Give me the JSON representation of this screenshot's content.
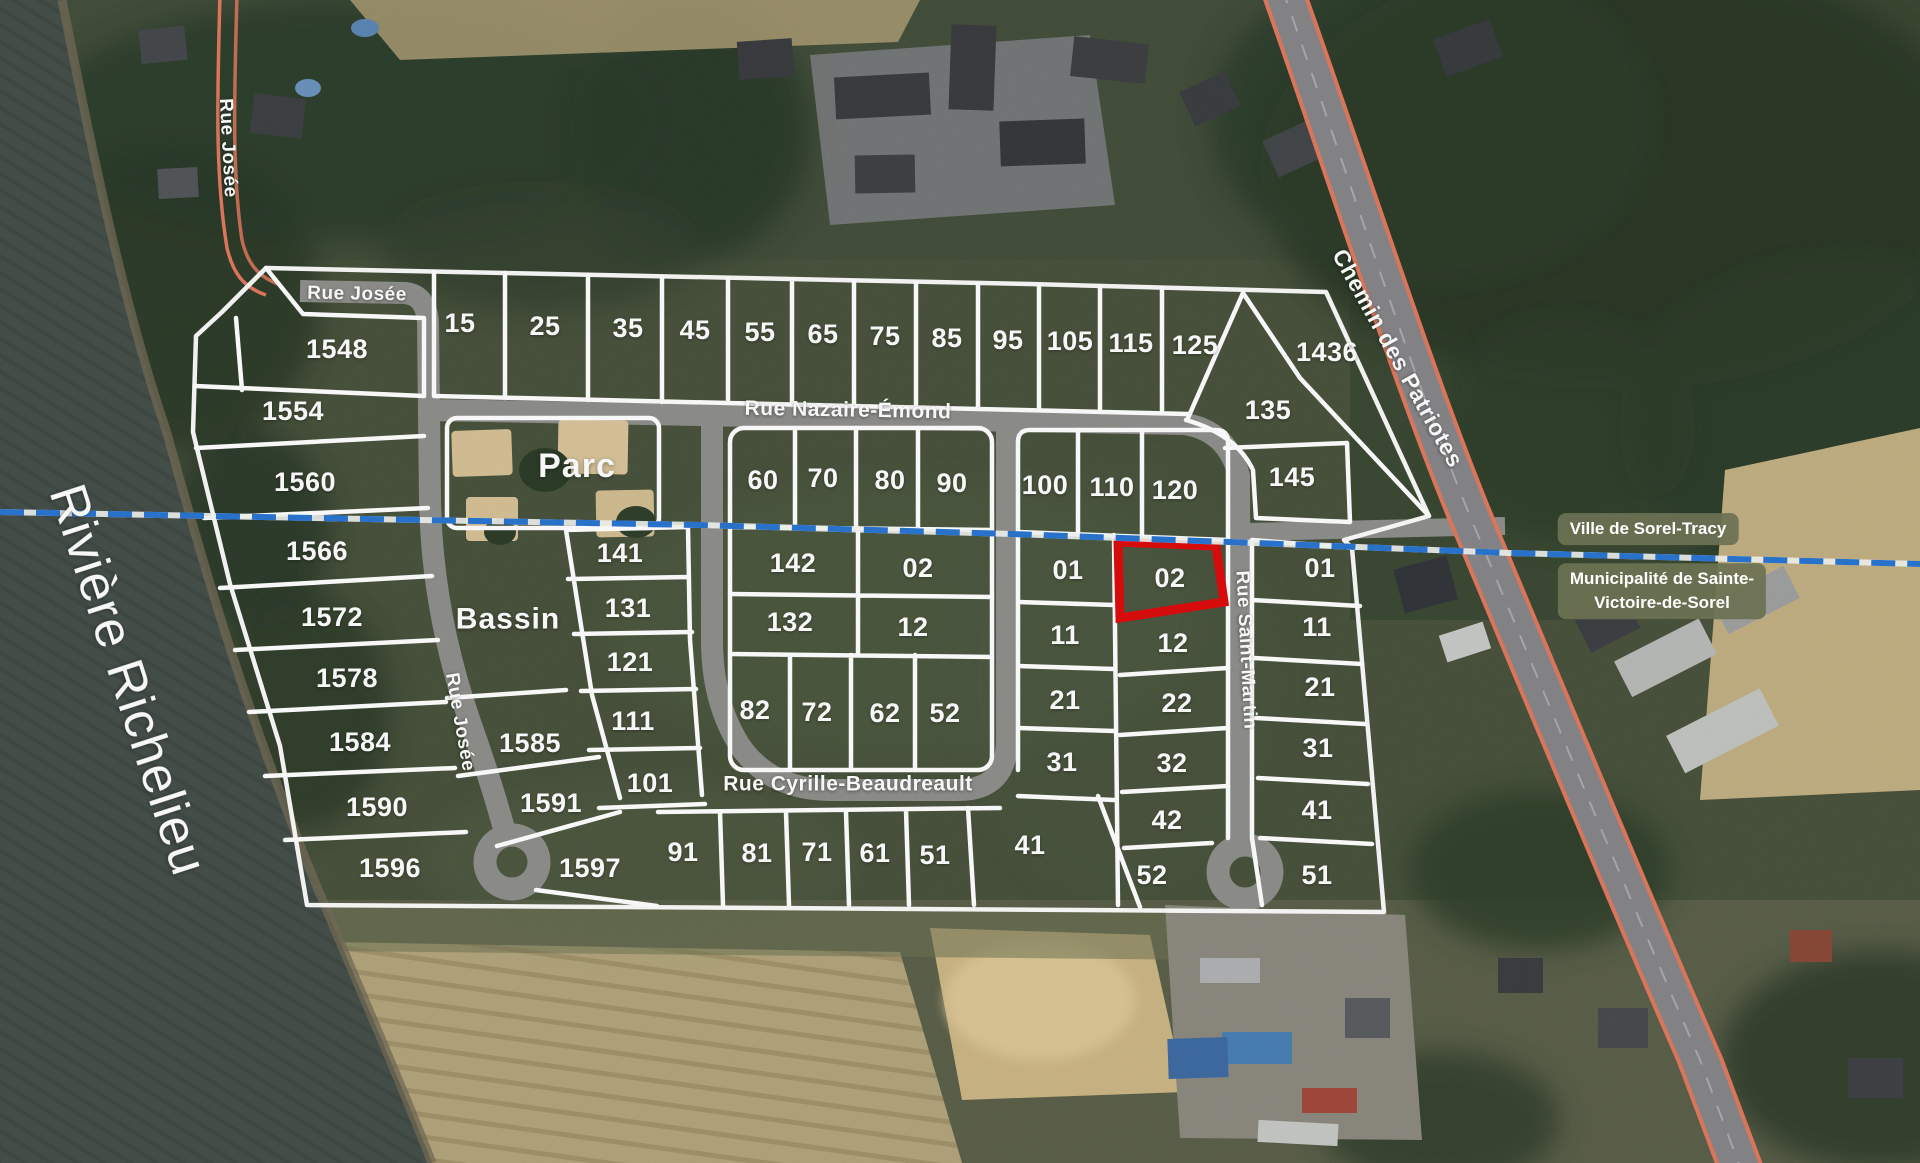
{
  "map": {
    "type": "subdivision-plat-satellite-map",
    "colors": {
      "highlight_lot": "#dd0d0d",
      "boundary_blue": "#2a76d2",
      "boundary_white": "#f4f6f3",
      "parcel_line": "#ffffff",
      "road_gray": "#8f8f8c",
      "highway_orange": "#e2795e",
      "badge_bg": "#6c7153"
    },
    "region_labels": [
      {
        "t": "Rivière Richelieu",
        "x": 128,
        "y": 680,
        "r": 72,
        "s": 52,
        "w": 500
      },
      {
        "t": "Parc",
        "x": 577,
        "y": 466,
        "r": 0,
        "s": 34,
        "w": 700
      },
      {
        "t": "Bassin",
        "x": 508,
        "y": 619,
        "r": 0,
        "s": 30,
        "w": 700
      }
    ],
    "street_labels": [
      {
        "t": "Rue Josée",
        "x": 357,
        "y": 294,
        "r": 1,
        "s": 19
      },
      {
        "t": "Rue Josée",
        "x": 228,
        "y": 148,
        "r": 87,
        "s": 19
      },
      {
        "t": "Rue Josée",
        "x": 460,
        "y": 722,
        "r": 80,
        "s": 19
      },
      {
        "t": "Rue Nazaire-Émond",
        "x": 848,
        "y": 410,
        "r": 1,
        "s": 21
      },
      {
        "t": "Rue Cyrille-Beaudreault",
        "x": 848,
        "y": 784,
        "r": 0,
        "s": 21
      },
      {
        "t": "Rue Saint-Martin",
        "x": 1246,
        "y": 650,
        "r": 87,
        "s": 19
      },
      {
        "t": "Chemin des Patriotes",
        "x": 1398,
        "y": 358,
        "r": 61,
        "s": 23
      }
    ],
    "boundary_badges": [
      {
        "line1": "Ville de Sorel-Tracy",
        "line2": ""
      },
      {
        "line1": "Municipalité de Sainte-",
        "line2": "Victoire-de-Sorel"
      }
    ],
    "highlighted_lot": {
      "n": "02",
      "x": 1170,
      "y": 578
    },
    "lots": [
      {
        "n": "15",
        "x": 460,
        "y": 323
      },
      {
        "n": "25",
        "x": 545,
        "y": 326
      },
      {
        "n": "35",
        "x": 628,
        "y": 328
      },
      {
        "n": "45",
        "x": 695,
        "y": 330
      },
      {
        "n": "55",
        "x": 760,
        "y": 332
      },
      {
        "n": "65",
        "x": 823,
        "y": 334
      },
      {
        "n": "75",
        "x": 885,
        "y": 336
      },
      {
        "n": "85",
        "x": 947,
        "y": 338
      },
      {
        "n": "95",
        "x": 1008,
        "y": 340
      },
      {
        "n": "105",
        "x": 1070,
        "y": 341
      },
      {
        "n": "115",
        "x": 1131,
        "y": 343
      },
      {
        "n": "125",
        "x": 1195,
        "y": 345
      },
      {
        "n": "1436",
        "x": 1327,
        "y": 352
      },
      {
        "n": "135",
        "x": 1268,
        "y": 410
      },
      {
        "n": "145",
        "x": 1292,
        "y": 477
      },
      {
        "n": "1548",
        "x": 337,
        "y": 349
      },
      {
        "n": "1554",
        "x": 293,
        "y": 411
      },
      {
        "n": "1560",
        "x": 305,
        "y": 482
      },
      {
        "n": "1566",
        "x": 317,
        "y": 551
      },
      {
        "n": "1572",
        "x": 332,
        "y": 617
      },
      {
        "n": "1578",
        "x": 347,
        "y": 678
      },
      {
        "n": "1584",
        "x": 360,
        "y": 742
      },
      {
        "n": "1590",
        "x": 377,
        "y": 807
      },
      {
        "n": "1596",
        "x": 390,
        "y": 868
      },
      {
        "n": "141",
        "x": 620,
        "y": 553
      },
      {
        "n": "131",
        "x": 628,
        "y": 608
      },
      {
        "n": "121",
        "x": 630,
        "y": 662
      },
      {
        "n": "111",
        "x": 633,
        "y": 721
      },
      {
        "n": "101",
        "x": 650,
        "y": 783
      },
      {
        "n": "1585",
        "x": 530,
        "y": 743
      },
      {
        "n": "1591",
        "x": 551,
        "y": 803
      },
      {
        "n": "1597",
        "x": 590,
        "y": 868
      },
      {
        "n": "60",
        "x": 763,
        "y": 480
      },
      {
        "n": "70",
        "x": 823,
        "y": 478
      },
      {
        "n": "80",
        "x": 890,
        "y": 480
      },
      {
        "n": "90",
        "x": 952,
        "y": 483
      },
      {
        "n": "142",
        "x": 793,
        "y": 563
      },
      {
        "n": "02",
        "x": 918,
        "y": 568
      },
      {
        "n": "132",
        "x": 790,
        "y": 622
      },
      {
        "n": "12",
        "x": 913,
        "y": 627
      },
      {
        "n": "82",
        "x": 755,
        "y": 710
      },
      {
        "n": "72",
        "x": 817,
        "y": 712
      },
      {
        "n": "62",
        "x": 885,
        "y": 713
      },
      {
        "n": "52",
        "x": 945,
        "y": 713
      },
      {
        "n": "91",
        "x": 683,
        "y": 852
      },
      {
        "n": "81",
        "x": 757,
        "y": 853
      },
      {
        "n": "71",
        "x": 817,
        "y": 852
      },
      {
        "n": "61",
        "x": 875,
        "y": 853
      },
      {
        "n": "51",
        "x": 935,
        "y": 855
      },
      {
        "n": "41",
        "x": 1030,
        "y": 845
      },
      {
        "n": "100",
        "x": 1045,
        "y": 485
      },
      {
        "n": "110",
        "x": 1112,
        "y": 487
      },
      {
        "n": "120",
        "x": 1175,
        "y": 490
      },
      {
        "n": "01",
        "x": 1068,
        "y": 570
      },
      {
        "n": "02",
        "x": 1170,
        "y": 578
      },
      {
        "n": "11",
        "x": 1065,
        "y": 635
      },
      {
        "n": "12",
        "x": 1173,
        "y": 643
      },
      {
        "n": "21",
        "x": 1065,
        "y": 700
      },
      {
        "n": "22",
        "x": 1177,
        "y": 703
      },
      {
        "n": "31",
        "x": 1062,
        "y": 762
      },
      {
        "n": "32",
        "x": 1172,
        "y": 763
      },
      {
        "n": "42",
        "x": 1167,
        "y": 820
      },
      {
        "n": "52",
        "x": 1152,
        "y": 875
      },
      {
        "n": "01",
        "x": 1320,
        "y": 568
      },
      {
        "n": "11",
        "x": 1317,
        "y": 627
      },
      {
        "n": "21",
        "x": 1320,
        "y": 687
      },
      {
        "n": "31",
        "x": 1318,
        "y": 748
      },
      {
        "n": "41",
        "x": 1317,
        "y": 810
      },
      {
        "n": "51",
        "x": 1317,
        "y": 875
      }
    ]
  }
}
